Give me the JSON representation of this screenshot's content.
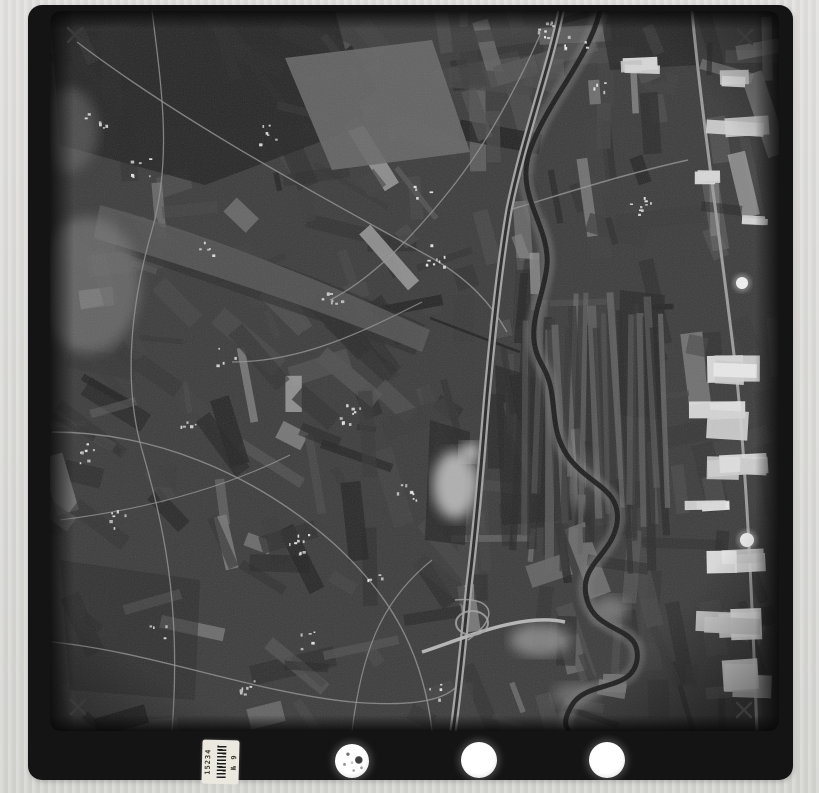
{
  "canvas": {
    "width": 819,
    "height": 793,
    "background": "#d6d6d3"
  },
  "alt": "black-and-white aerial survey photograph: patchwork farmland, meandering river valley, motorway and industrial outskirts; scanned film frame with fiducial marks, registration holes and archive sticker",
  "film_frame": {
    "x": 28,
    "y": 5,
    "width": 765,
    "height": 775,
    "radius": 14,
    "color": "#141414"
  },
  "fiducial_marks": {
    "color": "#3a3a3a",
    "positions": [
      [
        75,
        35
      ],
      [
        745,
        37
      ],
      [
        78,
        707
      ],
      [
        744,
        710
      ]
    ]
  },
  "registration_holes": [
    {
      "cx": 352,
      "cy": 761,
      "r": 17,
      "speckled": true
    },
    {
      "cx": 479,
      "cy": 760,
      "r": 18,
      "speckled": false
    },
    {
      "cx": 607,
      "cy": 760,
      "r": 18,
      "speckled": false
    }
  ],
  "label_sticker": {
    "x": 202,
    "y": 740,
    "width": 37,
    "height": 44,
    "number": "15234",
    "series": "№ 9"
  },
  "photo": {
    "area": {
      "x": 50,
      "y": 11,
      "w": 729,
      "h": 720,
      "radius": 10
    },
    "base": "#3b3b3b",
    "field_texture": {
      "count": 330,
      "seed": 7
    },
    "strip_fields_right": {
      "x": 516,
      "y": 292,
      "w": 152,
      "h": 278,
      "count": 26
    },
    "dark_patches": [
      {
        "d": "M50,11 L335,11 L365,125 L205,185 L60,145 Z",
        "fill": "#232323",
        "op": 0.85
      },
      {
        "d": "M120,215 C230,245 330,280 425,325 L415,355 C305,315 185,275 115,250 Z",
        "fill": "#2b2b2b",
        "op": 0.65
      },
      {
        "d": "M495,365 L560,385 L572,520 L502,525 Z",
        "fill": "#262626",
        "op": 0.75
      },
      {
        "d": "M600,12 L690,12 L700,65 L610,70 Z",
        "fill": "#252525",
        "op": 0.8
      },
      {
        "d": "M430,420 L470,432 L465,545 L425,540 Z",
        "fill": "#242424",
        "op": 0.75
      },
      {
        "d": "M60,560 L200,580 L195,700 L70,690 Z",
        "fill": "#2a2a2a",
        "op": 0.55
      },
      {
        "d": "M620,290 L665,295 L660,420 L618,415 Z",
        "fill": "#262626",
        "op": 0.7
      }
    ],
    "light_patches": [
      {
        "d": "M285,58 L432,40 L470,152 L332,170 Z",
        "fill": "#676767",
        "op": 0.9
      },
      {
        "d": "M100,205 C210,235 320,280 430,330 L422,352 C310,305 190,268 94,238 Z",
        "fill": "#585858",
        "op": 0.8
      },
      {
        "type": "ellipse",
        "cx": 88,
        "cy": 285,
        "rx": 52,
        "ry": 68,
        "fill": "#7d7d7d",
        "op": 0.6,
        "blur": true
      },
      {
        "type": "ellipse",
        "cx": 68,
        "cy": 130,
        "rx": 30,
        "ry": 42,
        "fill": "#6f6f6f",
        "op": 0.5,
        "blur": true
      },
      {
        "type": "ellipse",
        "cx": 455,
        "cy": 485,
        "rx": 22,
        "ry": 34,
        "fill": "#c7c7c7",
        "op": 0.85,
        "blur": true
      },
      {
        "type": "ellipse",
        "cx": 470,
        "cy": 452,
        "rx": 10,
        "ry": 10,
        "fill": "#d6d6d6",
        "op": 0.8,
        "blur": true
      },
      {
        "type": "ellipse",
        "cx": 540,
        "cy": 640,
        "rx": 30,
        "ry": 16,
        "fill": "#9f9f9f",
        "op": 0.7,
        "blur": true
      },
      {
        "type": "ellipse",
        "cx": 585,
        "cy": 480,
        "rx": 16,
        "ry": 30,
        "fill": "#8f8f8f",
        "op": 0.55,
        "blur": true
      },
      {
        "type": "ellipse",
        "cx": 610,
        "cy": 610,
        "rx": 18,
        "ry": 14,
        "fill": "#969696",
        "op": 0.6,
        "blur": true
      },
      {
        "type": "ellipse",
        "cx": 575,
        "cy": 695,
        "rx": 22,
        "ry": 12,
        "fill": "#8a8a8a",
        "op": 0.55,
        "blur": true
      }
    ],
    "river": {
      "d": "M600,11 C588,60 548,100 530,150 C514,195 550,225 547,265 C544,300 522,330 542,365 C560,395 547,425 567,455 C587,485 622,488 617,523 C612,556 577,565 587,600 C597,635 642,625 637,660 C632,692 587,680 572,705 C562,722 566,727 569,731",
      "bank": "#787878",
      "water": "#191919",
      "bank_w": 15,
      "water_w": 5
    },
    "tributary": {
      "d": "M430,318 C462,330 492,342 520,352",
      "color": "#1f1f1f",
      "w": 2.5
    },
    "highway": {
      "d": "M561,11 C549,70 523,140 509,210 C499,270 493,330 487,395 C482,455 477,520 469,585 C463,645 459,690 453,731",
      "edge": "#a2a2a2",
      "center": "#262626",
      "edge_w": 7.5,
      "center_w": 3
    },
    "cross_road": {
      "d": "M422,652 C460,640 520,612 565,622",
      "color": "#b5b5b5",
      "w": 3.5
    },
    "right_road": {
      "d": "M692,11 C702,120 722,250 737,380 C747,480 752,600 757,731",
      "color": "#9b9b9b",
      "w": 3
    },
    "interchange": {
      "cx": 472,
      "cy": 623,
      "rx": 16,
      "ry": 12,
      "ramp": "M455,600 C492,596 502,616 468,640",
      "color": "#a5a5a5"
    },
    "roads": [
      {
        "d": "M77,42 C180,120 300,185 432,258 C470,280 492,305 507,332",
        "w": 1.4
      },
      {
        "d": "M152,11 C162,90 172,160 152,230 C132,300 122,380 142,450 C162,520 182,600 172,731",
        "w": 1.3
      },
      {
        "d": "M52,432 C152,432 252,472 332,542 C382,587 422,642 432,731",
        "w": 1.4
      },
      {
        "d": "M52,642 C152,652 252,692 352,702 C412,707 442,700 455,688",
        "w": 1.3
      },
      {
        "d": "M232,362 C302,362 362,332 422,302",
        "w": 1.2
      },
      {
        "d": "M352,731 C362,650 382,600 432,560",
        "w": 1.2
      },
      {
        "d": "M509,210 C560,195 620,175 688,160",
        "w": 1.5
      },
      {
        "d": "M540,35 C520,80 490,140 450,190 C410,240 370,280 330,300",
        "w": 1.3
      },
      {
        "d": "M60,520 C140,510 220,490 290,455",
        "w": 1.1
      }
    ],
    "villages": [
      [
        140,
        165
      ],
      [
        95,
        120
      ],
      [
        225,
        355
      ],
      [
        190,
        420
      ],
      [
        300,
        545
      ],
      [
        155,
        635
      ],
      [
        245,
        690
      ],
      [
        370,
        585
      ],
      [
        420,
        190
      ],
      [
        435,
        255
      ],
      [
        330,
        300
      ],
      [
        545,
        30
      ],
      [
        575,
        45
      ],
      [
        640,
        205
      ],
      [
        120,
        520
      ],
      [
        82,
        452
      ],
      [
        265,
        135
      ],
      [
        350,
        415
      ],
      [
        405,
        495
      ],
      [
        210,
        250
      ],
      [
        310,
        640
      ],
      [
        430,
        690
      ],
      [
        600,
        80
      ]
    ],
    "factories": [
      [
        712,
        68,
        58,
        22
      ],
      [
        702,
        108,
        68,
        38
      ],
      [
        688,
        168,
        34,
        18
      ],
      [
        738,
        214,
        32,
        13
      ],
      [
        698,
        352,
        72,
        32
      ],
      [
        688,
        400,
        82,
        42
      ],
      [
        698,
        455,
        72,
        30
      ],
      [
        683,
        500,
        62,
        22
      ],
      [
        703,
        545,
        67,
        32
      ],
      [
        693,
        605,
        72,
        37
      ],
      [
        718,
        660,
        57,
        37
      ],
      [
        620,
        58,
        42,
        16
      ]
    ],
    "tanks": [
      [
        742,
        283,
        6
      ],
      [
        747,
        540,
        7
      ]
    ]
  }
}
